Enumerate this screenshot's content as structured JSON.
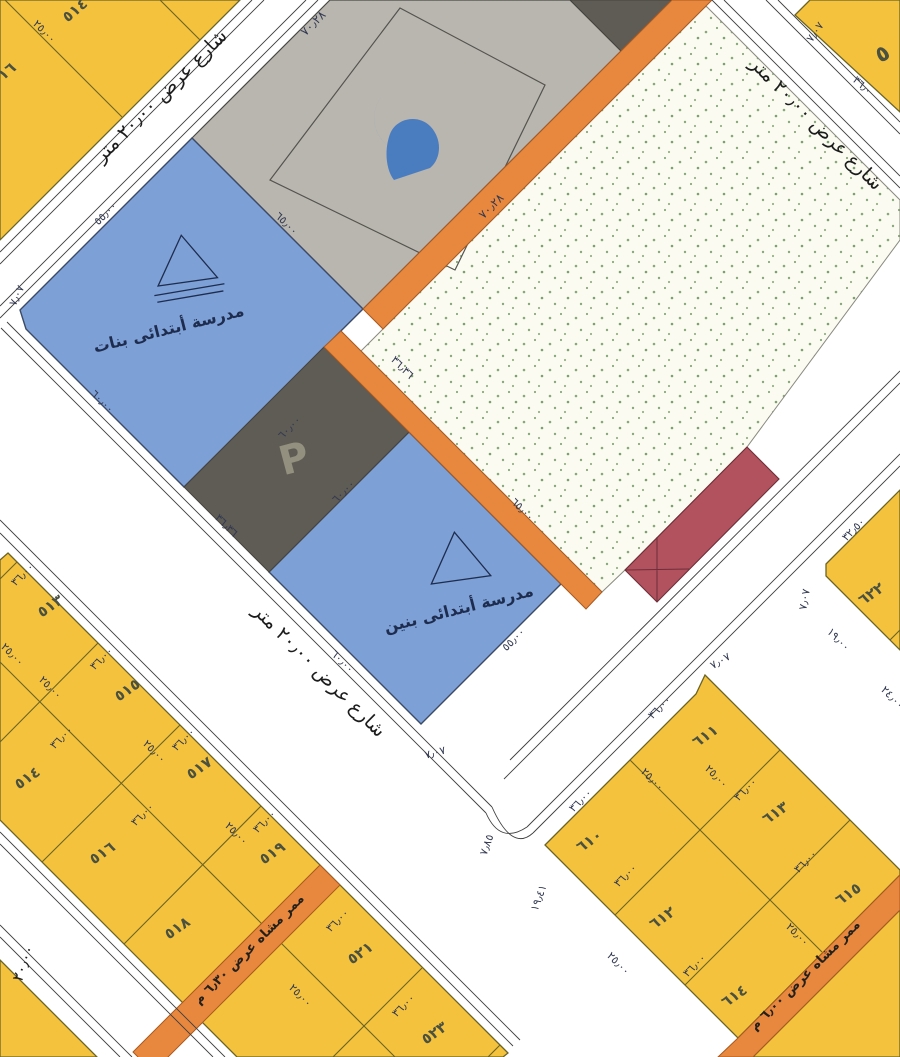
{
  "map": {
    "streets": {
      "northwest_street": "شارع عرض ٢٠٫٠٠ متر",
      "central_street": "شارع عرض ٢٠٫٠٠ متر",
      "northeast_street": "شارع عرض ٢٠٫٠٠ متر",
      "west_street_width": "٢٠٫٠٠"
    },
    "walkways": {
      "southwest": "ممر مشاه عرض ٦٫٣٠ م",
      "southeast": "ممر مشاه عرض ٦٫٠٠ م"
    },
    "mosque": {
      "dim_nw": "٧٠٫٢٨",
      "dim_se": "٧٠٫٢٨"
    },
    "girls_school": {
      "name": "مدرسة أبتدائى بنات",
      "dim_nw": "٥٥٫٠٠",
      "dim_ne": "٦٥٫٠٠",
      "dim_se": "٦٠٫٠٠",
      "dim_sw": "٦٠٫٠٠",
      "chamfer": "٧٫٠٧"
    },
    "boys_school": {
      "name": "مدرسة أبتدائى بنين",
      "dim_nw": "٦٠٫٠٠",
      "dim_ne": "٦٥٫٠٠",
      "dim_se": "٥٥٫٠٠",
      "dim_sw": "٦٠٫٠٠",
      "chamfer": "٧٫٠٧"
    },
    "parking": {
      "symbol": "P",
      "dim_ne": "٣٦٫٣٦",
      "dim_sw": "٣٦٫٣٦"
    },
    "blocks": {
      "top_left": {
        "numbers": [
          "٥١٤",
          "١٦"
        ],
        "dims": [
          "٢٥٫٠٠"
        ]
      },
      "bottom_left": {
        "numbers": [
          "٥١٣",
          "٥١٥",
          "٥١٧",
          "٥١٩",
          "٥٢١",
          "٥٢٣",
          "٥١٤",
          "٥١٦",
          "٥١٨"
        ],
        "front_dim": "٣٦٫٠٠",
        "side_dim": "٢٥٫٠٠"
      },
      "southeast": {
        "numbers": [
          "٦١٠",
          "٦١١",
          "٦١٢",
          "٦١٣",
          "٦١٤",
          "٦١٥"
        ],
        "front_dim": "٣٦٫٠٠",
        "side_dim": "٢٥٫٠٠",
        "corner_chamfer": "٧٫٠٧",
        "curve_dims": [
          "٧٫٨٥",
          "١٩٫٤١"
        ]
      },
      "east": {
        "number": "٦٢٢",
        "dims": [
          "٣٢٫٥٠",
          "٧٫٠٧",
          "١٩٫٠٠",
          "٢٤٫٠٠"
        ]
      },
      "northeast_corner": {
        "number": "٥",
        "dims": [
          "٧٫٠٧",
          "٣٦٫٠"
        ]
      }
    }
  }
}
